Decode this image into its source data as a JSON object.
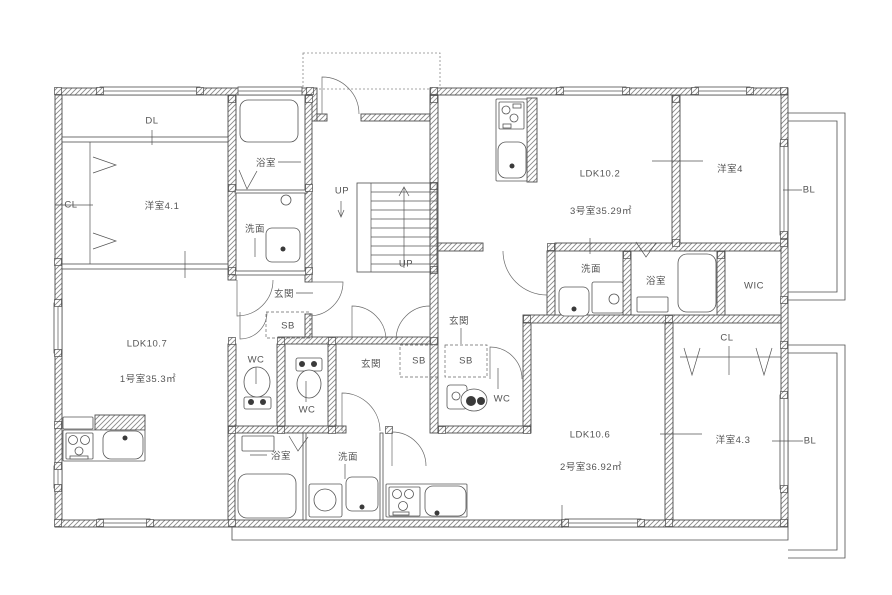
{
  "meta": {
    "type": "architectural-floor-plan",
    "language": "ja"
  },
  "colors": {
    "background": "#ffffff",
    "line": "#4d4d4d",
    "text": "#555555"
  },
  "units": [
    {
      "id": "1",
      "room_label": "1号室35.3㎡",
      "ldk_label": "LDK10.7"
    },
    {
      "id": "2",
      "room_label": "2号室36.92㎡",
      "ldk_label": "LDK10.6"
    },
    {
      "id": "3",
      "room_label": "3号室35.29㎡",
      "ldk_label": "LDK10.2"
    }
  ],
  "labels": [
    {
      "name": "label-dl",
      "text": "DL",
      "x": 152,
      "y": 121
    },
    {
      "name": "label-cl-room1",
      "text": "CL",
      "x": 71,
      "y": 205
    },
    {
      "name": "label-yoshitsu-4-1",
      "text": "洋室4.1",
      "x": 162,
      "y": 205
    },
    {
      "name": "label-bath-room1",
      "text": "浴室",
      "x": 266,
      "y": 162
    },
    {
      "name": "label-senmen-room1",
      "text": "洗面",
      "x": 255,
      "y": 228
    },
    {
      "name": "label-genkan-room1",
      "text": "玄関",
      "x": 284,
      "y": 293
    },
    {
      "name": "label-sb-room1",
      "text": "SB",
      "x": 288,
      "y": 326
    },
    {
      "name": "label-wc-room1",
      "text": "WC",
      "x": 256,
      "y": 360
    },
    {
      "name": "label-ldk-room1",
      "text": "LDK10.7",
      "x": 147,
      "y": 344
    },
    {
      "name": "label-area-room1",
      "text": "1号室35.3㎡",
      "x": 148,
      "y": 378
    },
    {
      "name": "label-up-1",
      "text": "UP",
      "x": 342,
      "y": 191
    },
    {
      "name": "label-up-2",
      "text": "UP",
      "x": 406,
      "y": 264
    },
    {
      "name": "label-genkan-room2",
      "text": "玄関",
      "x": 371,
      "y": 363
    },
    {
      "name": "label-sb-room2",
      "text": "SB",
      "x": 419,
      "y": 361
    },
    {
      "name": "label-wc-room2",
      "text": "WC",
      "x": 307,
      "y": 410
    },
    {
      "name": "label-bath-room2",
      "text": "浴室",
      "x": 281,
      "y": 455
    },
    {
      "name": "label-senmen-room2",
      "text": "洗面",
      "x": 348,
      "y": 456
    },
    {
      "name": "label-ldk-room2",
      "text": "LDK10.6",
      "x": 590,
      "y": 435
    },
    {
      "name": "label-area-room2",
      "text": "2号室36.92㎡",
      "x": 591,
      "y": 466
    },
    {
      "name": "label-cl-room2",
      "text": "CL",
      "x": 727,
      "y": 338
    },
    {
      "name": "label-yoshitsu-4-3",
      "text": "洋室4.3",
      "x": 733,
      "y": 439
    },
    {
      "name": "label-bl-bottom",
      "text": "BL",
      "x": 810,
      "y": 441
    },
    {
      "name": "label-ldk-room3",
      "text": "LDK10.2",
      "x": 600,
      "y": 174
    },
    {
      "name": "label-area-room3",
      "text": "3号室35.29㎡",
      "x": 601,
      "y": 210
    },
    {
      "name": "label-senmen-room3",
      "text": "洗面",
      "x": 591,
      "y": 268
    },
    {
      "name": "label-bath-room3",
      "text": "浴室",
      "x": 656,
      "y": 280
    },
    {
      "name": "label-wic",
      "text": "WIC",
      "x": 754,
      "y": 286
    },
    {
      "name": "label-yoshitsu-4",
      "text": "洋室4",
      "x": 730,
      "y": 168
    },
    {
      "name": "label-bl-top",
      "text": "BL",
      "x": 809,
      "y": 190
    },
    {
      "name": "label-genkan-room3",
      "text": "玄関",
      "x": 459,
      "y": 320
    },
    {
      "name": "label-sb-room3",
      "text": "SB",
      "x": 466,
      "y": 361
    },
    {
      "name": "label-wc-room3",
      "text": "WC",
      "x": 502,
      "y": 399
    }
  ]
}
